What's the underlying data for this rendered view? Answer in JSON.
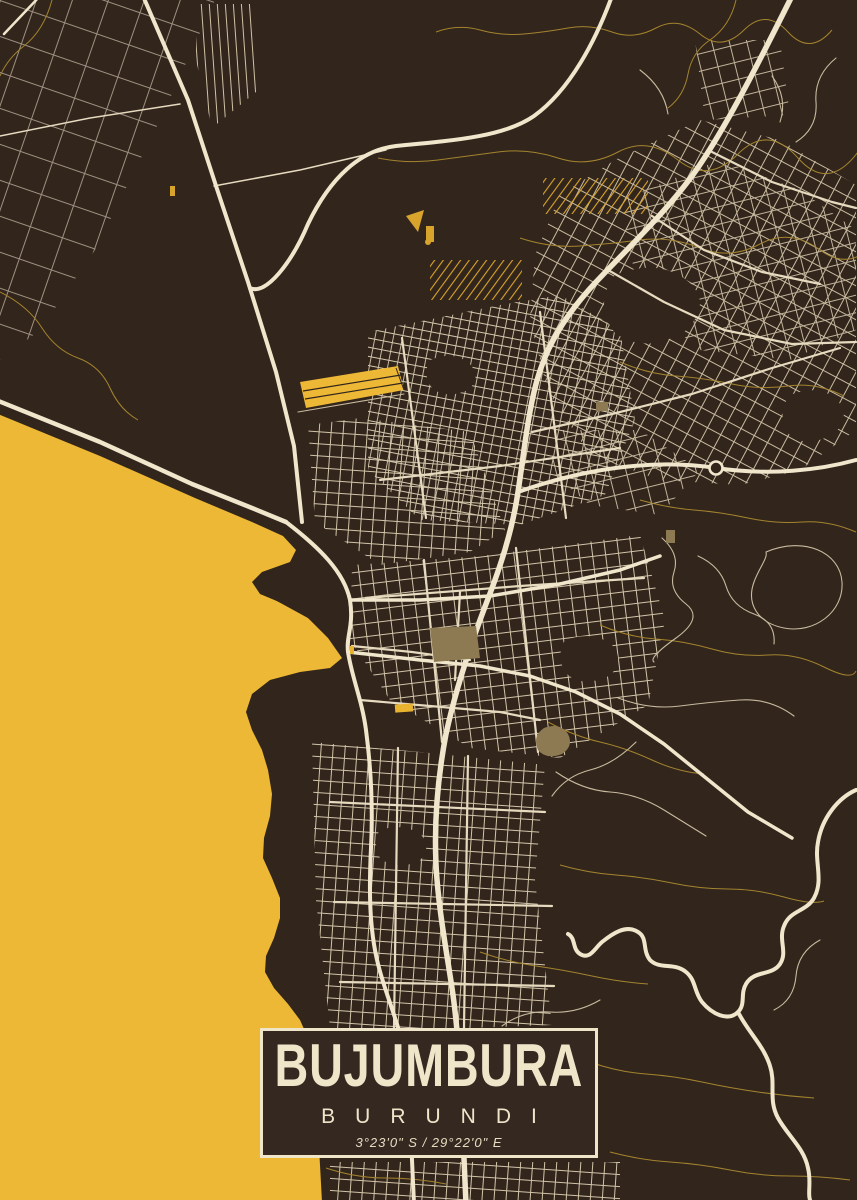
{
  "poster": {
    "title": "BUJUMBURA",
    "subtitle": "BURUNDI",
    "coordinates": "3°23'0\" S / 29°22'0\" E"
  },
  "map": {
    "colors": {
      "background": "#32251c",
      "water": "#edb836",
      "road_major": "#f0e6cb",
      "road_medium": "#e6dabf",
      "road_minor": "#c8bb9f",
      "contour_line": "#a3842e",
      "accent_yellow": "#d9a42c",
      "area_tan": "#8d7a52",
      "text": "#efe5c9"
    }
  }
}
